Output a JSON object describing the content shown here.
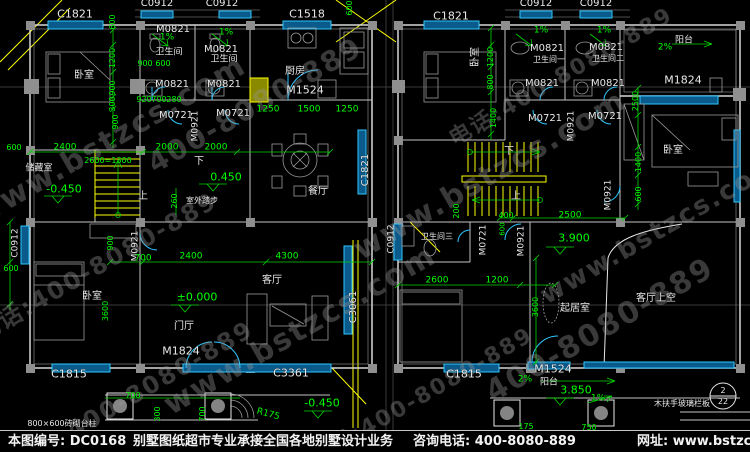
{
  "colors": {
    "g": "#00ff00",
    "w": "#e8e8e8",
    "c": "#2fc8ff",
    "y": "#ffff00"
  },
  "footer": {
    "number": "本图编号: DC0168",
    "service": "别墅图纸超市专业承接全国各地别墅设计业务",
    "phone": "咨询电话: 400-8080-889",
    "website": "网址: www.bstzcs.com"
  },
  "watermarks": [
    [
      "www.bstzcs.com",
      110,
      140,
      -30,
      30
    ],
    [
      "电话:400-8080-889",
      95,
      265,
      -30,
      24
    ],
    [
      "400-8080-889",
      255,
      105,
      -30,
      28
    ],
    [
      "www.bstzcs.com",
      300,
      330,
      -30,
      30
    ],
    [
      "www.bstzcs.com",
      490,
      175,
      -30,
      30
    ],
    [
      "电话:400-8080-889",
      560,
      75,
      -30,
      22
    ],
    [
      "400-8080-889",
      600,
      330,
      -30,
      30
    ],
    [
      "www.bstzcs.com",
      660,
      230,
      -30,
      26
    ],
    [
      "电话:400-8080-889",
      420,
      395,
      -30,
      22
    ],
    [
      "400-8080-889",
      160,
      380,
      -30,
      24
    ]
  ],
  "drawing": {
    "labels": [
      [
        "C1821",
        75,
        14,
        "w",
        0,
        11,
        "window-code"
      ],
      [
        "C0912",
        157,
        4,
        "w",
        0,
        10,
        "window-code"
      ],
      [
        "C0912",
        222,
        4,
        "w",
        0,
        10,
        "window-code"
      ],
      [
        "C1518",
        307,
        14,
        "w",
        0,
        11,
        "window-code"
      ],
      [
        "C1821",
        451,
        16,
        "w",
        0,
        11,
        "window-code"
      ],
      [
        "C0912",
        536,
        4,
        "w",
        0,
        10,
        "window-code"
      ],
      [
        "C0912",
        596,
        4,
        "w",
        0,
        10,
        "window-code"
      ],
      [
        "C1821",
        366,
        170,
        "w",
        -90,
        10,
        "window-code"
      ],
      [
        "C0912",
        16,
        243,
        "w",
        -90,
        9,
        "window-code"
      ],
      [
        "C3061",
        354,
        307,
        "w",
        -90,
        10,
        "window-code"
      ],
      [
        "C0912",
        392,
        239,
        "w",
        -90,
        9,
        "window-code"
      ],
      [
        "C1815",
        69,
        374,
        "w",
        0,
        11,
        "window-code"
      ],
      [
        "C3361",
        291,
        373,
        "w",
        0,
        11,
        "window-code"
      ],
      [
        "C1815",
        464,
        374,
        "w",
        0,
        11,
        "window-code"
      ],
      [
        "M0821",
        173,
        30,
        "w",
        0,
        10,
        "door-code"
      ],
      [
        "M0821",
        221,
        50,
        "w",
        0,
        10,
        "door-code"
      ],
      [
        "M0821",
        172,
        85,
        "w",
        0,
        10,
        "door-code"
      ],
      [
        "M0821",
        224,
        85,
        "w",
        0,
        10,
        "door-code"
      ],
      [
        "M0721",
        176,
        116,
        "w",
        0,
        10,
        "door-code"
      ],
      [
        "M0721",
        233,
        114,
        "w",
        0,
        10,
        "door-code"
      ],
      [
        "M0921",
        196,
        126,
        "w",
        -90,
        9,
        "door-code"
      ],
      [
        "M1524",
        305,
        90,
        "w",
        0,
        11,
        "door-code"
      ],
      [
        "M1824",
        181,
        351,
        "w",
        0,
        11,
        "door-code"
      ],
      [
        "M0921",
        136,
        246,
        "w",
        -90,
        9,
        "door-code"
      ],
      [
        "M0821",
        547,
        49,
        "w",
        0,
        10,
        "door-code"
      ],
      [
        "M0821",
        606,
        48,
        "w",
        0,
        10,
        "door-code"
      ],
      [
        "M0821",
        542,
        84,
        "w",
        0,
        10,
        "door-code"
      ],
      [
        "M0821",
        608,
        84,
        "w",
        0,
        10,
        "door-code"
      ],
      [
        "M0721",
        545,
        119,
        "w",
        0,
        10,
        "door-code"
      ],
      [
        "M0721",
        605,
        117,
        "w",
        0,
        10,
        "door-code"
      ],
      [
        "M0921",
        572,
        126,
        "w",
        -90,
        9,
        "door-code"
      ],
      [
        "M1824",
        683,
        80,
        "w",
        0,
        11,
        "door-code"
      ],
      [
        "M0921",
        609,
        195,
        "w",
        -90,
        9,
        "door-code"
      ],
      [
        "M0921",
        522,
        241,
        "w",
        -90,
        9,
        "door-code"
      ],
      [
        "M0721",
        484,
        240,
        "w",
        -90,
        9,
        "door-code"
      ],
      [
        "M1524",
        553,
        369,
        "w",
        0,
        11,
        "door-code"
      ],
      [
        "卧室",
        84,
        76,
        "w",
        0,
        10,
        "room-label"
      ],
      [
        "卫生间",
        169,
        53,
        "w",
        0,
        9,
        "room-label"
      ],
      [
        "卫生间",
        224,
        60,
        "w",
        0,
        9,
        "room-label"
      ],
      [
        "厨房",
        295,
        72,
        "w",
        0,
        10,
        "room-label"
      ],
      [
        "餐厅",
        318,
        192,
        "w",
        0,
        10,
        "room-label"
      ],
      [
        "储藏室",
        39,
        169,
        "w",
        0,
        9,
        "room-label"
      ],
      [
        "卧室",
        92,
        297,
        "w",
        0,
        10,
        "room-label"
      ],
      [
        "门厅",
        184,
        327,
        "w",
        0,
        10,
        "room-label"
      ],
      [
        "客厅",
        272,
        281,
        "w",
        0,
        10,
        "room-label"
      ],
      [
        "卧室",
        476,
        57,
        "w",
        -90,
        10,
        "room-label"
      ],
      [
        "卫生间一",
        549,
        60,
        "w",
        0,
        8,
        "room-label"
      ],
      [
        "卫生间二",
        608,
        59,
        "w",
        0,
        8,
        "room-label"
      ],
      [
        "阳台",
        684,
        41,
        "w",
        0,
        9,
        "room-label"
      ],
      [
        "卧室",
        673,
        151,
        "w",
        0,
        10,
        "room-label"
      ],
      [
        "卫生间三",
        437,
        237,
        "w",
        0,
        8,
        "room-label"
      ],
      [
        "起居室",
        575,
        309,
        "w",
        0,
        10,
        "room-label"
      ],
      [
        "客厅上空",
        656,
        299,
        "w",
        0,
        10,
        "room-label"
      ],
      [
        "阳台",
        549,
        383,
        "w",
        0,
        9,
        "room-label"
      ],
      [
        "900",
        145,
        64,
        "g",
        0,
        8,
        "dim"
      ],
      [
        "600",
        163,
        64,
        "g",
        0,
        8,
        "dim"
      ],
      [
        "920",
        144,
        100,
        "g",
        0,
        8,
        "dim"
      ],
      [
        "700",
        159,
        100,
        "g",
        0,
        8,
        "dim"
      ],
      [
        "280",
        174,
        100,
        "g",
        0,
        8,
        "dim"
      ],
      [
        "1250",
        268,
        110,
        "g",
        0,
        9,
        "dim"
      ],
      [
        "1500",
        309,
        110,
        "g",
        0,
        9,
        "dim"
      ],
      [
        "1250",
        347,
        110,
        "g",
        0,
        9,
        "dim"
      ],
      [
        "600",
        350,
        8,
        "g",
        -90,
        8,
        "dim"
      ],
      [
        "600",
        113,
        22,
        "g",
        -90,
        8,
        "dim"
      ],
      [
        "1200",
        113,
        58,
        "g",
        -90,
        8,
        "dim"
      ],
      [
        "900",
        113,
        88,
        "g",
        -90,
        8,
        "dim"
      ],
      [
        "300",
        113,
        104,
        "g",
        -90,
        8,
        "dim"
      ],
      [
        "900",
        116,
        122,
        "g",
        -90,
        8,
        "dim"
      ],
      [
        "2400",
        65,
        148,
        "g",
        0,
        9,
        "dim"
      ],
      [
        "2000",
        167,
        148,
        "g",
        0,
        9,
        "dim"
      ],
      [
        "2000",
        216,
        148,
        "g",
        0,
        9,
        "dim"
      ],
      [
        "600",
        14,
        148,
        "g",
        0,
        8,
        "dim"
      ],
      [
        "2600=1300",
        108,
        161,
        "g",
        0,
        8,
        "stair-note"
      ],
      [
        "260",
        175,
        201,
        "g",
        -90,
        8,
        "dim"
      ],
      [
        "900",
        111,
        243,
        "g",
        -90,
        8,
        "dim"
      ],
      [
        "700",
        143,
        259,
        "g",
        0,
        9,
        "dim"
      ],
      [
        "2400",
        191,
        257,
        "g",
        0,
        9,
        "dim"
      ],
      [
        "4300",
        287,
        257,
        "g",
        0,
        9,
        "dim"
      ],
      [
        "600",
        11,
        269,
        "g",
        0,
        8,
        "dim"
      ],
      [
        "3600",
        106,
        311,
        "g",
        -90,
        8,
        "dim"
      ],
      [
        "700",
        133,
        396,
        "g",
        0,
        8,
        "dim"
      ],
      [
        "300",
        158,
        414,
        "g",
        -90,
        8,
        "dim"
      ],
      [
        "700",
        203,
        414,
        "g",
        -90,
        8,
        "dim"
      ],
      [
        "2500",
        636,
        101,
        "g",
        -90,
        8,
        "dim"
      ],
      [
        "1200",
        491,
        57,
        "g",
        -90,
        8,
        "dim"
      ],
      [
        "800",
        491,
        82,
        "g",
        -90,
        8,
        "dim"
      ],
      [
        "1400",
        494,
        118,
        "g",
        -90,
        8,
        "dim"
      ],
      [
        "200",
        457,
        211,
        "g",
        -90,
        8,
        "dim"
      ],
      [
        "1400",
        639,
        162,
        "g",
        -90,
        8,
        "dim"
      ],
      [
        "600",
        639,
        194,
        "g",
        -90,
        8,
        "dim"
      ],
      [
        "2500",
        570,
        216,
        "g",
        0,
        9,
        "dim"
      ],
      [
        "400",
        506,
        216,
        "g",
        0,
        8,
        "dim"
      ],
      [
        "600",
        503,
        229,
        "g",
        -90,
        7,
        "dim"
      ],
      [
        "2600",
        437,
        281,
        "g",
        0,
        9,
        "dim"
      ],
      [
        "1200",
        497,
        281,
        "g",
        0,
        9,
        "dim"
      ],
      [
        "3600",
        536,
        307,
        "g",
        -90,
        8,
        "dim"
      ],
      [
        "175",
        526,
        427,
        "g",
        0,
        8,
        "dim"
      ],
      [
        "750",
        589,
        428,
        "g",
        0,
        8,
        "dim"
      ],
      [
        "-0.450",
        64,
        189,
        "g",
        0,
        11,
        "level-mark"
      ],
      [
        "0.450",
        226,
        177,
        "g",
        0,
        11,
        "level-mark"
      ],
      [
        "±0.000",
        197,
        297,
        "g",
        0,
        11,
        "level-mark"
      ],
      [
        "-0.450",
        322,
        403,
        "g",
        0,
        11,
        "level-mark"
      ],
      [
        "3.900",
        574,
        238,
        "g",
        0,
        11,
        "level-mark"
      ],
      [
        "3.850",
        576,
        390,
        "g",
        0,
        11,
        "level-mark"
      ],
      [
        "1%",
        167,
        38,
        "g",
        0,
        9,
        "slope-label"
      ],
      [
        "1%",
        226,
        33,
        "g",
        0,
        9,
        "slope-label"
      ],
      [
        "1%",
        541,
        31,
        "g",
        0,
        9,
        "slope-label"
      ],
      [
        "1%",
        604,
        31,
        "g",
        0,
        9,
        "slope-label"
      ],
      [
        "2%",
        665,
        48,
        "g",
        0,
        9,
        "slope-label"
      ],
      [
        "2%",
        525,
        380,
        "g",
        0,
        9,
        "slope-label"
      ],
      [
        "1%",
        598,
        399,
        "g",
        0,
        9,
        "slope-label"
      ],
      [
        "下",
        199,
        162,
        "w",
        0,
        10,
        "stair-direction"
      ],
      [
        "上",
        143,
        197,
        "w",
        0,
        10,
        "stair-direction"
      ],
      [
        "下",
        509,
        152,
        "w",
        0,
        10,
        "stair-direction"
      ],
      [
        "上",
        516,
        197,
        "w",
        0,
        10,
        "stair-direction"
      ],
      [
        "R175",
        268,
        415,
        "g",
        15,
        9,
        "annotation"
      ],
      [
        "800×600砖砌台柱",
        62,
        424,
        "w",
        0,
        8,
        "annotation"
      ],
      [
        "室外踏步",
        202,
        201,
        "w",
        0,
        8,
        "annotation"
      ],
      [
        "木扶手玻璃栏板",
        682,
        404,
        "w",
        0,
        8,
        "annotation"
      ],
      [
        "2",
        723,
        391,
        "w",
        0,
        8,
        "detail-ref"
      ],
      [
        "22",
        723,
        402,
        "w",
        0,
        8,
        "detail-ref"
      ]
    ]
  }
}
